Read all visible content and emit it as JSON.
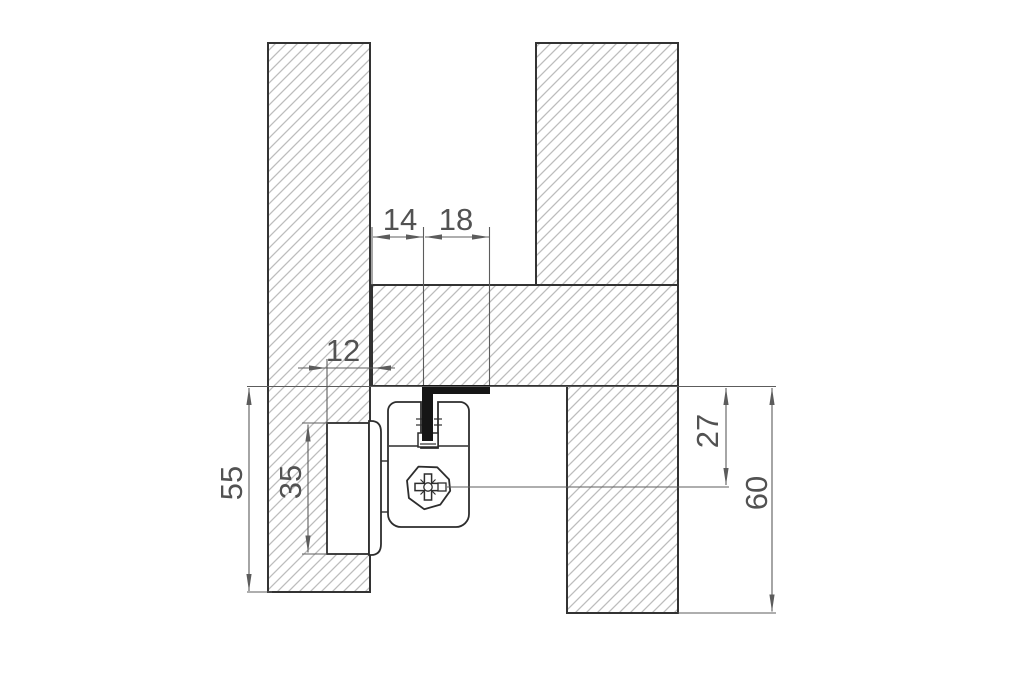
{
  "drawing": {
    "kind": "technical-cross-section",
    "dimension_labels": {
      "top_first": "14",
      "top_second": "18",
      "offset": "12",
      "left_outer": "55",
      "left_inner": "35",
      "right_inner": "27",
      "right_outer": "60"
    },
    "colors": {
      "background": "#ffffff",
      "panel_outline": "#333333",
      "hatch": "#bcbcbc",
      "fitting_outline": "#2d2d2d",
      "dimension_lines": "#5c5c5c",
      "dimension_text": "#525252",
      "profile_fill": "#161616"
    },
    "icons": {
      "screw": "phillips-screw"
    }
  }
}
